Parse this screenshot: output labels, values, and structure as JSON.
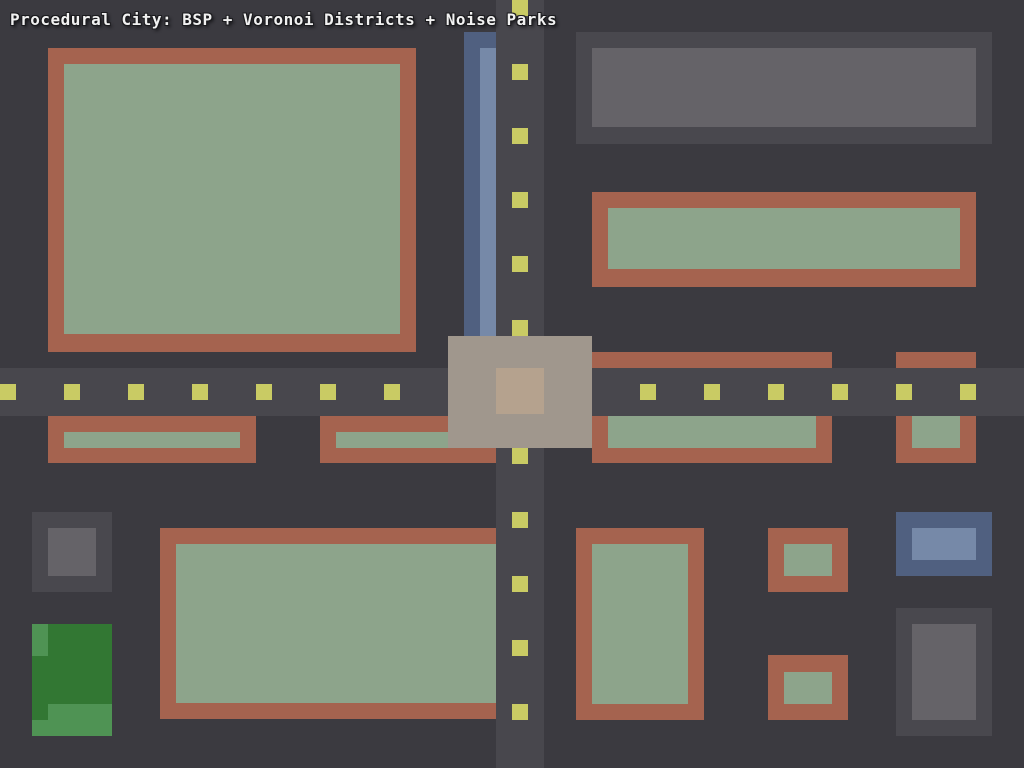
{
  "title": {
    "text": "Procedural City: BSP + Voronoi Districts + Noise Parks"
  },
  "palette": {
    "bg": "#3b3a40",
    "road": "#48474d",
    "dash": "#c9cb64",
    "wall": "#a5634f",
    "court": "#8da48b",
    "grayWall": "#49484e",
    "grayCore": "#656368",
    "blueWall": "#506080",
    "blueCore": "#7689a8",
    "parkDark": "#327733",
    "parkLight": "#4f9354",
    "plaza": "#a0978d",
    "plazaCore": "#b5a28e",
    "titleText": "#f1f1f1"
  },
  "scene": {
    "width": 1024,
    "height": 768,
    "background": "bg",
    "rects": [
      {
        "name": "building-nw-outer",
        "x": 48,
        "y": 48,
        "w": 368,
        "h": 304,
        "color": "wall"
      },
      {
        "name": "building-nw-inner",
        "x": 64,
        "y": 64,
        "w": 336,
        "h": 270,
        "color": "court"
      },
      {
        "name": "building-ne-gray-outer",
        "x": 576,
        "y": 32,
        "w": 416,
        "h": 112,
        "color": "grayWall"
      },
      {
        "name": "building-ne-gray-inner",
        "x": 592,
        "y": 48,
        "w": 384,
        "h": 79,
        "color": "grayCore"
      },
      {
        "name": "building-e-outer",
        "x": 592,
        "y": 192,
        "w": 384,
        "h": 95,
        "color": "wall"
      },
      {
        "name": "building-e-inner",
        "x": 608,
        "y": 208,
        "w": 352,
        "h": 61,
        "color": "court"
      },
      {
        "name": "canal-bank",
        "x": 464,
        "y": 32,
        "w": 32,
        "h": 304,
        "color": "blueWall"
      },
      {
        "name": "canal-water",
        "x": 480,
        "y": 48,
        "w": 16,
        "h": 288,
        "color": "blueCore"
      },
      {
        "name": "building-mw1-outer",
        "x": 48,
        "y": 416,
        "w": 208,
        "h": 47,
        "color": "wall"
      },
      {
        "name": "building-mw1-inner",
        "x": 64,
        "y": 432,
        "w": 176,
        "h": 16,
        "color": "court"
      },
      {
        "name": "building-mw2-outer",
        "x": 320,
        "y": 416,
        "w": 176,
        "h": 47,
        "color": "wall"
      },
      {
        "name": "building-mw2-inner",
        "x": 336,
        "y": 432,
        "w": 160,
        "h": 16,
        "color": "court"
      },
      {
        "name": "building-me1-outer",
        "x": 592,
        "y": 352,
        "w": 240,
        "h": 111,
        "color": "wall"
      },
      {
        "name": "building-me1-inner",
        "x": 608,
        "y": 368,
        "w": 208,
        "h": 80,
        "color": "court"
      },
      {
        "name": "building-me2-outer",
        "x": 896,
        "y": 352,
        "w": 80,
        "h": 111,
        "color": "wall"
      },
      {
        "name": "building-me2-inner",
        "x": 912,
        "y": 368,
        "w": 48,
        "h": 80,
        "color": "court"
      },
      {
        "name": "building-sw-gray-outer",
        "x": 32,
        "y": 512,
        "w": 80,
        "h": 80,
        "color": "grayWall"
      },
      {
        "name": "building-sw-gray-inner",
        "x": 48,
        "y": 528,
        "w": 48,
        "h": 48,
        "color": "grayCore"
      },
      {
        "name": "park-base",
        "x": 32,
        "y": 624,
        "w": 80,
        "h": 112,
        "color": "parkDark"
      },
      {
        "name": "park-patch",
        "x": 32,
        "y": 624,
        "w": 16,
        "h": 32,
        "color": "parkLight"
      },
      {
        "name": "park-patch",
        "x": 48,
        "y": 704,
        "w": 64,
        "h": 32,
        "color": "parkLight"
      },
      {
        "name": "park-patch",
        "x": 32,
        "y": 720,
        "w": 16,
        "h": 16,
        "color": "parkLight"
      },
      {
        "name": "building-s-large-outer",
        "x": 160,
        "y": 528,
        "w": 336,
        "h": 191,
        "color": "wall"
      },
      {
        "name": "building-s-large-inner",
        "x": 176,
        "y": 544,
        "w": 320,
        "h": 159,
        "color": "court"
      },
      {
        "name": "building-s-mid-outer",
        "x": 576,
        "y": 528,
        "w": 128,
        "h": 192,
        "color": "wall"
      },
      {
        "name": "building-s-mid-inner",
        "x": 592,
        "y": 544,
        "w": 96,
        "h": 160,
        "color": "court"
      },
      {
        "name": "building-s-small1-outer",
        "x": 768,
        "y": 528,
        "w": 80,
        "h": 64,
        "color": "wall"
      },
      {
        "name": "building-s-small1-inner",
        "x": 784,
        "y": 544,
        "w": 48,
        "h": 32,
        "color": "court"
      },
      {
        "name": "building-s-small2-outer",
        "x": 768,
        "y": 655,
        "w": 80,
        "h": 65,
        "color": "wall"
      },
      {
        "name": "building-s-small2-inner",
        "x": 784,
        "y": 672,
        "w": 48,
        "h": 32,
        "color": "court"
      },
      {
        "name": "building-se-blue-outer",
        "x": 896,
        "y": 512,
        "w": 96,
        "h": 64,
        "color": "blueWall"
      },
      {
        "name": "building-se-blue-inner",
        "x": 912,
        "y": 528,
        "w": 64,
        "h": 32,
        "color": "blueCore"
      },
      {
        "name": "building-se-gray-outer",
        "x": 896,
        "y": 608,
        "w": 96,
        "h": 128,
        "color": "grayWall"
      },
      {
        "name": "building-se-gray-inner",
        "x": 912,
        "y": 624,
        "w": 64,
        "h": 96,
        "color": "grayCore"
      },
      {
        "name": "road-horizontal",
        "x": 0,
        "y": 368,
        "w": 1024,
        "h": 48,
        "color": "road"
      },
      {
        "name": "road-vertical",
        "x": 496,
        "y": 0,
        "w": 48,
        "h": 768,
        "color": "road"
      },
      {
        "name": "road-dash-h",
        "x": 0,
        "y": 384,
        "w": 16,
        "h": 16,
        "color": "dash"
      },
      {
        "name": "road-dash-h",
        "x": 64,
        "y": 384,
        "w": 16,
        "h": 16,
        "color": "dash"
      },
      {
        "name": "road-dash-h",
        "x": 128,
        "y": 384,
        "w": 16,
        "h": 16,
        "color": "dash"
      },
      {
        "name": "road-dash-h",
        "x": 192,
        "y": 384,
        "w": 16,
        "h": 16,
        "color": "dash"
      },
      {
        "name": "road-dash-h",
        "x": 256,
        "y": 384,
        "w": 16,
        "h": 16,
        "color": "dash"
      },
      {
        "name": "road-dash-h",
        "x": 320,
        "y": 384,
        "w": 16,
        "h": 16,
        "color": "dash"
      },
      {
        "name": "road-dash-h",
        "x": 384,
        "y": 384,
        "w": 16,
        "h": 16,
        "color": "dash"
      },
      {
        "name": "road-dash-h",
        "x": 448,
        "y": 384,
        "w": 16,
        "h": 16,
        "color": "dash"
      },
      {
        "name": "road-dash-h",
        "x": 512,
        "y": 384,
        "w": 16,
        "h": 16,
        "color": "dash"
      },
      {
        "name": "road-dash-h",
        "x": 576,
        "y": 384,
        "w": 16,
        "h": 16,
        "color": "dash"
      },
      {
        "name": "road-dash-h",
        "x": 640,
        "y": 384,
        "w": 16,
        "h": 16,
        "color": "dash"
      },
      {
        "name": "road-dash-h",
        "x": 704,
        "y": 384,
        "w": 16,
        "h": 16,
        "color": "dash"
      },
      {
        "name": "road-dash-h",
        "x": 768,
        "y": 384,
        "w": 16,
        "h": 16,
        "color": "dash"
      },
      {
        "name": "road-dash-h",
        "x": 832,
        "y": 384,
        "w": 16,
        "h": 16,
        "color": "dash"
      },
      {
        "name": "road-dash-h",
        "x": 896,
        "y": 384,
        "w": 16,
        "h": 16,
        "color": "dash"
      },
      {
        "name": "road-dash-h",
        "x": 960,
        "y": 384,
        "w": 16,
        "h": 16,
        "color": "dash"
      },
      {
        "name": "road-dash-v",
        "x": 512,
        "y": 0,
        "w": 16,
        "h": 16,
        "color": "dash"
      },
      {
        "name": "road-dash-v",
        "x": 512,
        "y": 64,
        "w": 16,
        "h": 16,
        "color": "dash"
      },
      {
        "name": "road-dash-v",
        "x": 512,
        "y": 128,
        "w": 16,
        "h": 16,
        "color": "dash"
      },
      {
        "name": "road-dash-v",
        "x": 512,
        "y": 192,
        "w": 16,
        "h": 16,
        "color": "dash"
      },
      {
        "name": "road-dash-v",
        "x": 512,
        "y": 256,
        "w": 16,
        "h": 16,
        "color": "dash"
      },
      {
        "name": "road-dash-v",
        "x": 512,
        "y": 320,
        "w": 16,
        "h": 16,
        "color": "dash"
      },
      {
        "name": "road-dash-v",
        "x": 512,
        "y": 384,
        "w": 16,
        "h": 16,
        "color": "dash"
      },
      {
        "name": "road-dash-v",
        "x": 512,
        "y": 448,
        "w": 16,
        "h": 16,
        "color": "dash"
      },
      {
        "name": "road-dash-v",
        "x": 512,
        "y": 512,
        "w": 16,
        "h": 16,
        "color": "dash"
      },
      {
        "name": "road-dash-v",
        "x": 512,
        "y": 576,
        "w": 16,
        "h": 16,
        "color": "dash"
      },
      {
        "name": "road-dash-v",
        "x": 512,
        "y": 640,
        "w": 16,
        "h": 16,
        "color": "dash"
      },
      {
        "name": "road-dash-v",
        "x": 512,
        "y": 704,
        "w": 16,
        "h": 16,
        "color": "dash"
      },
      {
        "name": "plaza",
        "x": 448,
        "y": 336,
        "w": 144,
        "h": 112,
        "color": "plaza"
      },
      {
        "name": "plaza-center",
        "x": 496,
        "y": 368,
        "w": 48,
        "h": 46,
        "color": "plazaCore"
      }
    ]
  }
}
